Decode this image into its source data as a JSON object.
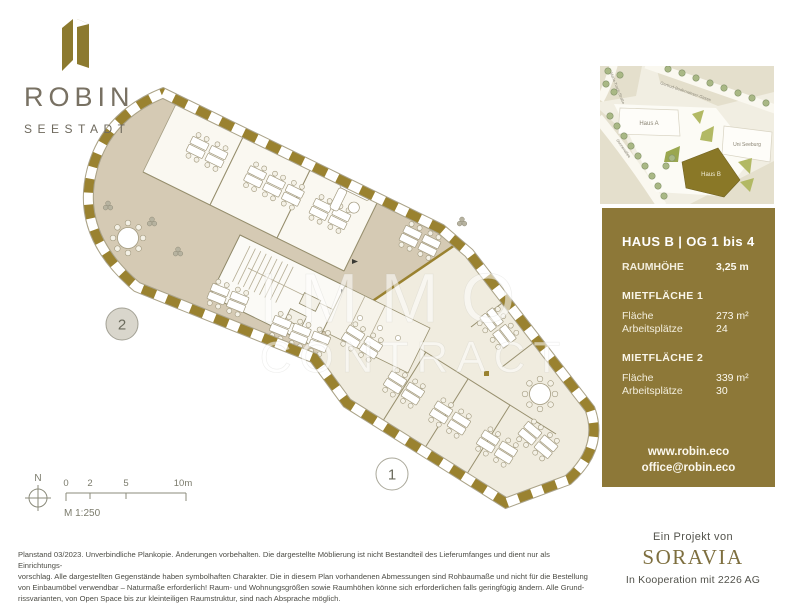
{
  "brand": {
    "name": "ROBIN",
    "location": "SEESTADT"
  },
  "watermark": {
    "line1": "IMMO",
    "line2": "CONTRACT"
  },
  "site_map": {
    "haus_a": "Haus A",
    "uni": "Uni Seeburg",
    "haus_b": "Haus B",
    "street_left": "Maria-Tusch-Straße",
    "street_top": "Gertrud-Bodenwieser-Gasse",
    "street_bottom": "Sonnenallee"
  },
  "info_panel": {
    "title": "HAUS B | OG 1 bis 4",
    "room_height": {
      "label": "RAUMHÖHE",
      "value": "3,25 m"
    },
    "sections": [
      {
        "heading": "MIETFLÄCHE 1",
        "rows": [
          {
            "label": "Fläche",
            "value": "273 m²"
          },
          {
            "label": "Arbeitsplätze",
            "value": "24"
          }
        ]
      },
      {
        "heading": "MIETFLÄCHE 2",
        "rows": [
          {
            "label": "Fläche",
            "value": "339 m²"
          },
          {
            "label": "Arbeitsplätze",
            "value": "30"
          }
        ]
      }
    ],
    "website": "www.robin.eco",
    "email": "office@robin.eco"
  },
  "plan": {
    "units": {
      "unit1": "1",
      "unit2": "2"
    },
    "compass": "N",
    "scale": {
      "tick0": "0",
      "tick2": "2",
      "tick5": "5",
      "tick10": "10m",
      "ratio": "M 1:250"
    }
  },
  "project": {
    "prefix": "Ein Projekt von",
    "name": "SORAVIA",
    "cooperation": "In Kooperation mit 2226 AG"
  },
  "disclaimer": {
    "lines": [
      "Planstand 03/2023. Unverbindliche Plankopie. Änderungen vorbehalten. Die dargestellte Möblierung ist nicht Bestandteil des Lieferumfanges und dient nur als Einrichtungs-",
      "vorschlag. Alle dargestellten Gegenstände haben symbolhaften Charakter. Die in diesem Plan vorhandenen Abmessungen sind Rohbaumaße und nicht für die Bestellung",
      "von Einbaumöbel verwendbar – Naturmaße erforderlich! Raum- und Wohnungsgrößen sowie Raumhöhen könne sich erforderlichen falls geringfügig ändern. Alle Grund-",
      "rissvarianten, von Open Space bis zur kleinteiligen Raumstruktur, sind nach Absprache möglich."
    ]
  },
  "colors": {
    "brand_olive": "#8c7a2f",
    "panel_bg": "#8d7838",
    "floor_tan": "#d5cab4",
    "floor_cream": "#f0ecdf",
    "wall_olive": "#9a8230",
    "haus_b_fill": "#8a7827"
  }
}
